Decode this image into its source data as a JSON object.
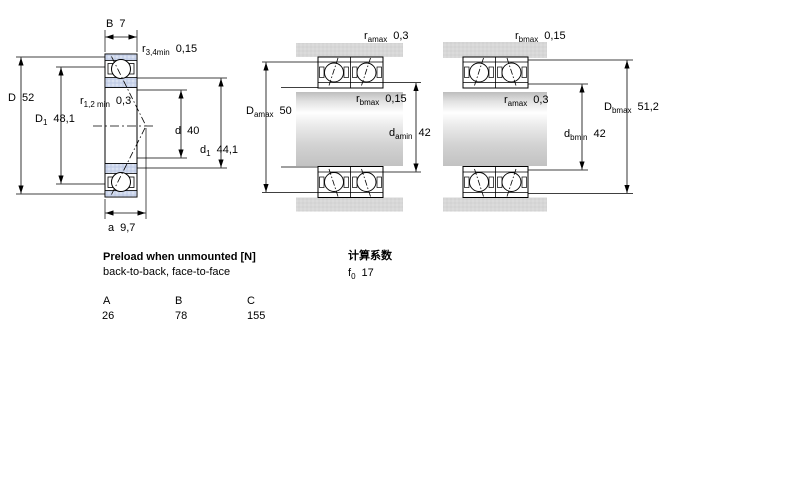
{
  "figure_left": {
    "labels": {
      "B": {
        "main": "B",
        "sub": "",
        "value": "7"
      },
      "r34": {
        "main": "r",
        "sub": "3,4min",
        "value": "0,15"
      },
      "D": {
        "main": "D",
        "sub": "",
        "value": "52"
      },
      "D1": {
        "main": "D",
        "sub": "1",
        "value": "48,1"
      },
      "r12": {
        "main": "r",
        "sub": "1,2 min",
        "value": "0,3"
      },
      "d": {
        "main": "d",
        "sub": "",
        "value": "40"
      },
      "d1": {
        "main": "d",
        "sub": "1",
        "value": "44,1"
      },
      "a": {
        "main": "a",
        "sub": "",
        "value": "9,7"
      }
    }
  },
  "figure_middle": {
    "labels": {
      "ramax": {
        "main": "r",
        "sub": "amax",
        "value": "0,3"
      },
      "Damax": {
        "main": "D",
        "sub": "amax",
        "value": "50"
      },
      "rbmax": {
        "main": "r",
        "sub": "bmax",
        "value": "0,15"
      },
      "damin": {
        "main": "d",
        "sub": "amin",
        "value": "42"
      }
    }
  },
  "figure_right": {
    "labels": {
      "rbmax": {
        "main": "r",
        "sub": "bmax",
        "value": "0,15"
      },
      "ramax": {
        "main": "r",
        "sub": "amax",
        "value": "0,3"
      },
      "Dbmax": {
        "main": "D",
        "sub": "bmax",
        "value": "51,2"
      },
      "dbmin": {
        "main": "d",
        "sub": "bmin",
        "value": "42"
      }
    }
  },
  "preload": {
    "title": "Preload when unmounted [N]",
    "subtitle": "back-to-back, face-to-face",
    "columns": [
      "A",
      "B",
      "C"
    ],
    "values": [
      "26",
      "78",
      "155"
    ]
  },
  "calc": {
    "title": "计算系数",
    "f0": {
      "main": "f",
      "sub": "0",
      "value": "17"
    }
  },
  "colors": {
    "ring_blue": "#cbd5eb",
    "housing_gray": "#d7d7d7",
    "line": "#000000"
  }
}
